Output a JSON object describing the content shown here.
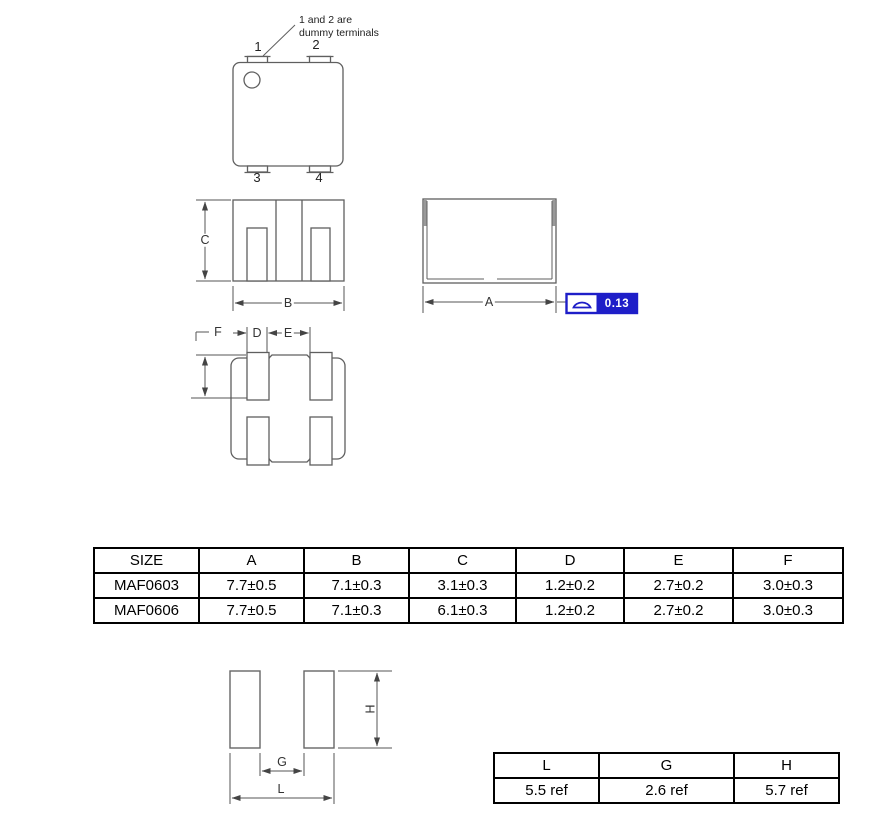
{
  "top_view": {
    "note_line1": "1 and 2 are",
    "note_line2": "dummy terminals",
    "terminal_1": "1",
    "terminal_2": "2",
    "terminal_3": "3",
    "terminal_4": "4"
  },
  "dims": {
    "a": "A",
    "b": "B",
    "c": "C",
    "d": "D",
    "e": "E",
    "f": "F",
    "g": "G",
    "l": "L",
    "h": "H"
  },
  "gdt": {
    "symbol": "profile-of-surface",
    "value": "0.13",
    "color": "#1e1ec8"
  },
  "size_table": {
    "headers": [
      "SIZE",
      "A",
      "B",
      "C",
      "D",
      "E",
      "F"
    ],
    "rows": [
      [
        "MAF0603",
        "7.7±0.5",
        "7.1±0.3",
        "3.1±0.3",
        "1.2±0.2",
        "2.7±0.2",
        "3.0±0.3"
      ],
      [
        "MAF0606",
        "7.7±0.5",
        "7.1±0.3",
        "6.1±0.3",
        "1.2±0.2",
        "2.7±0.2",
        "3.0±0.3"
      ]
    ]
  },
  "land_table": {
    "headers": [
      "L",
      "G",
      "H"
    ],
    "values": [
      "5.5 ref",
      "2.6 ref",
      "5.7 ref"
    ]
  }
}
